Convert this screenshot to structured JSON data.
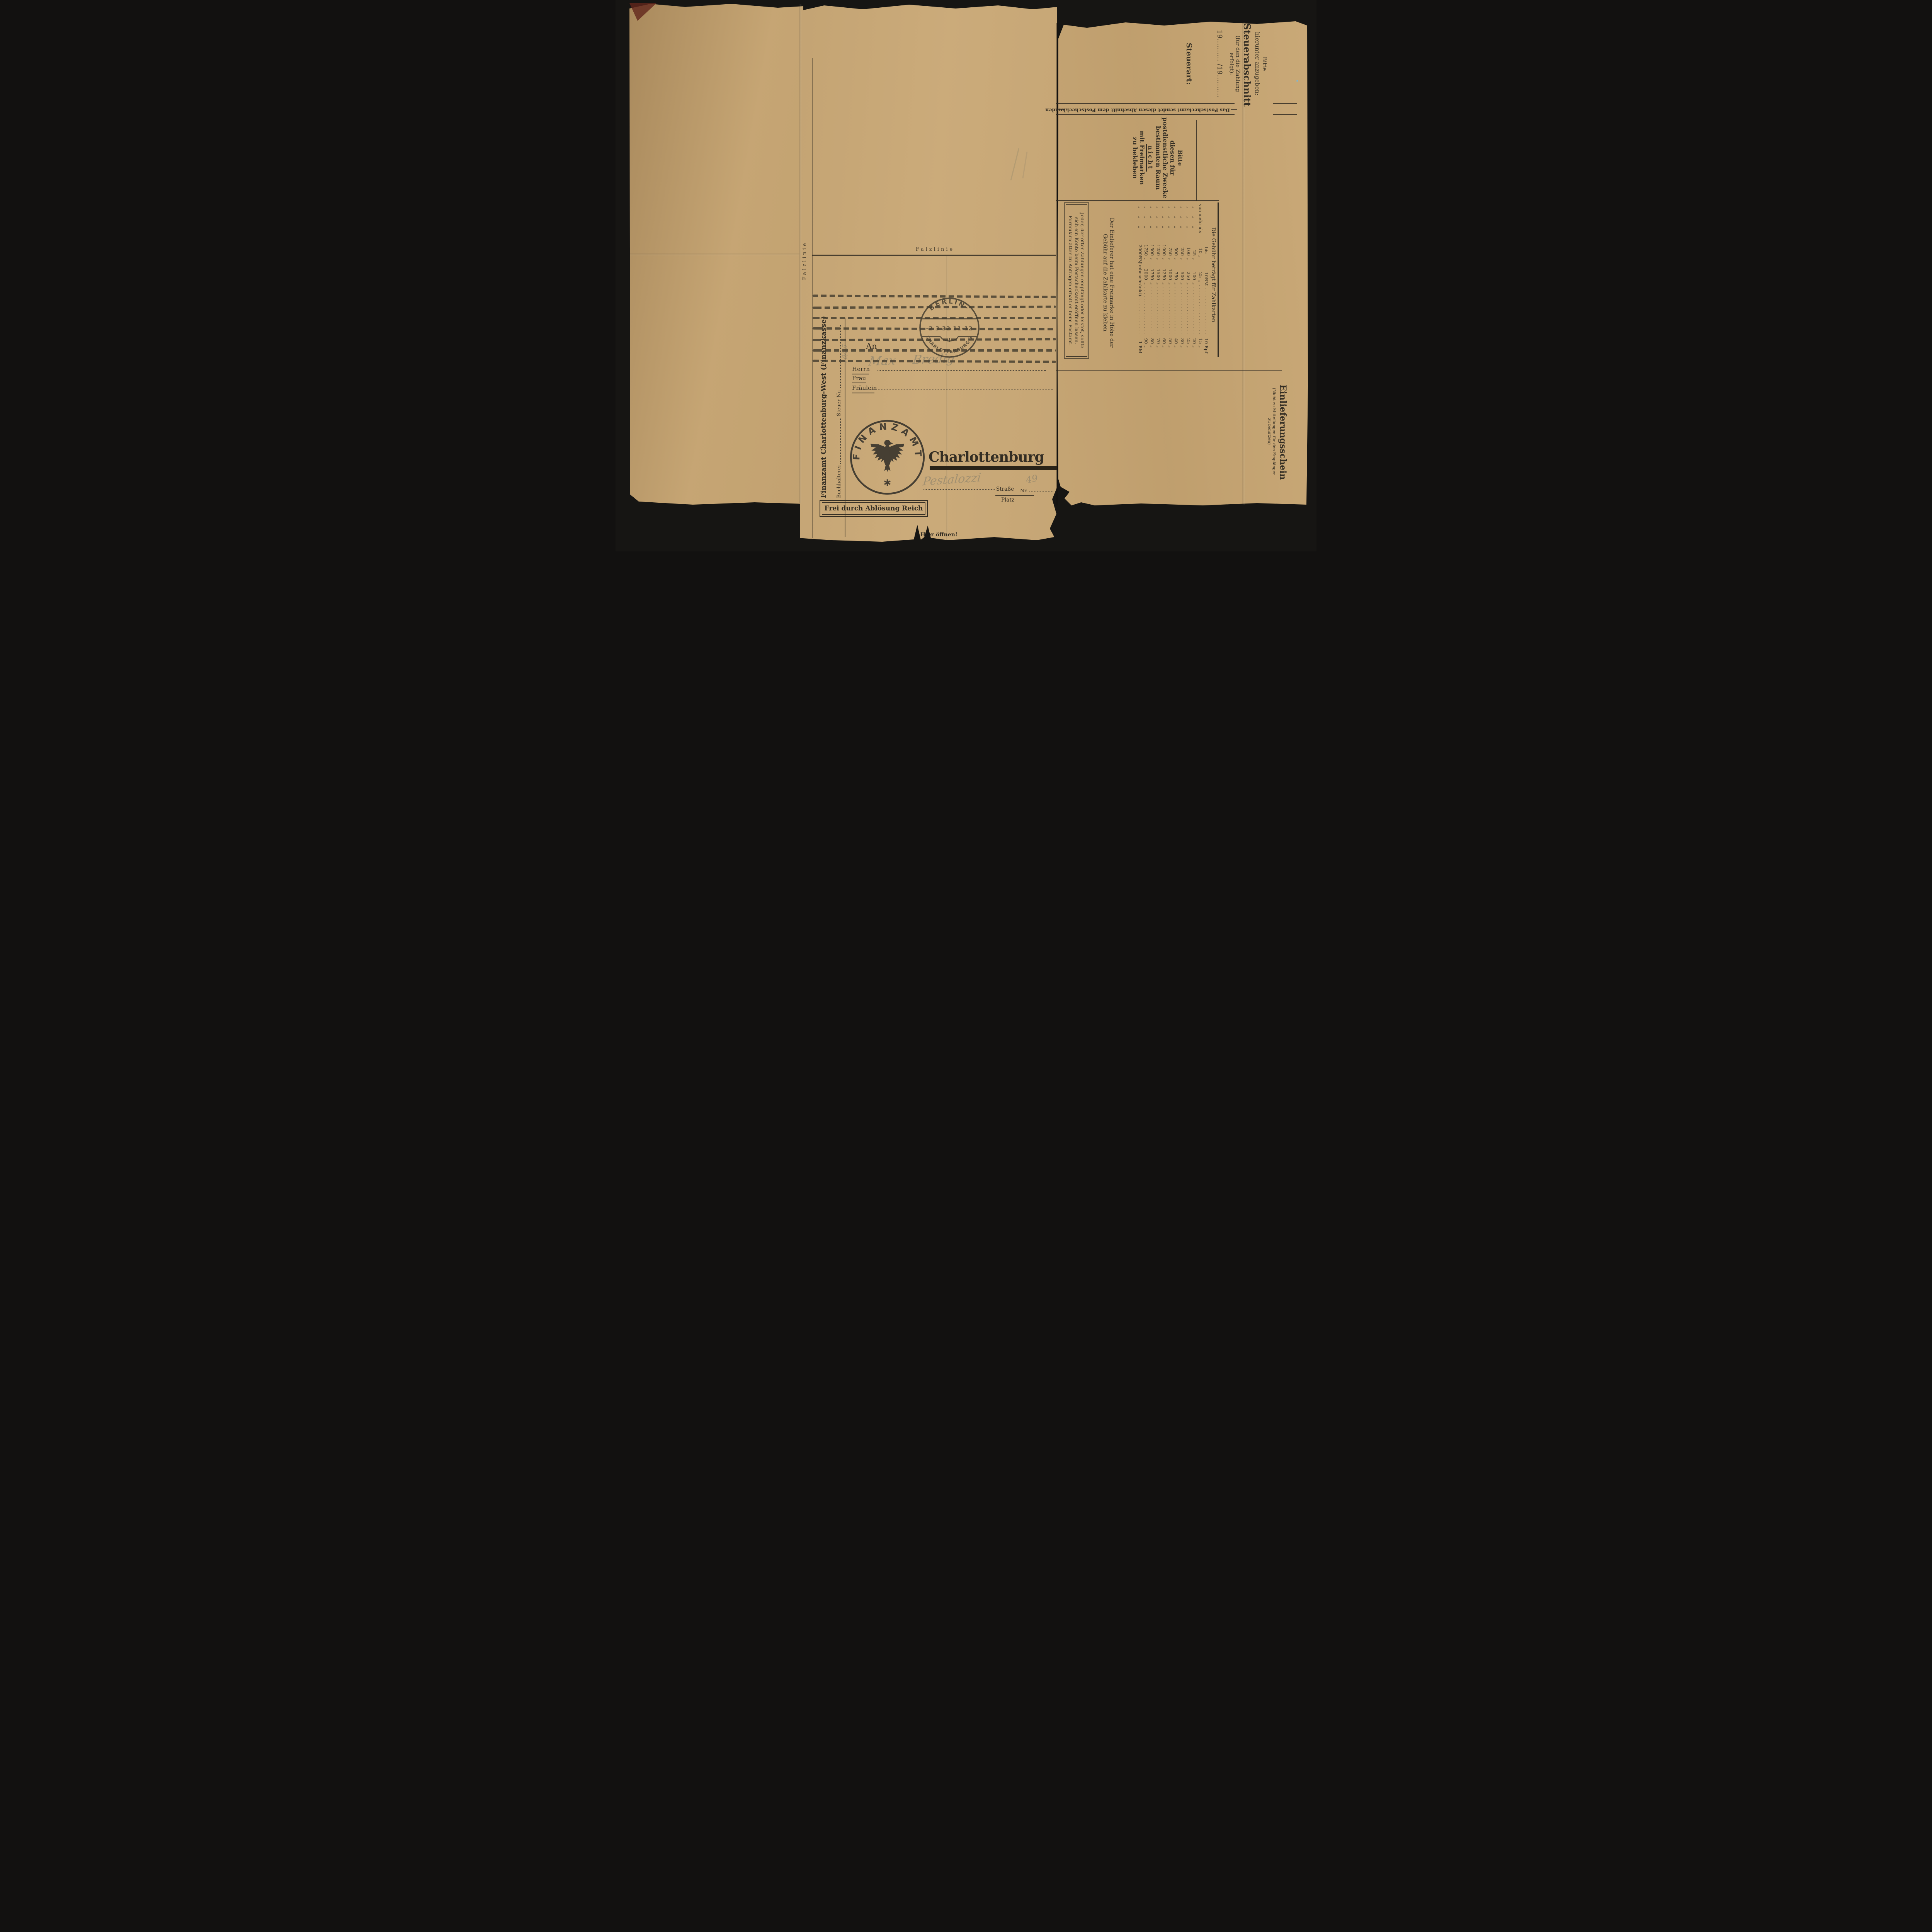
{
  "colors": {
    "paper": "#c7a572",
    "paper_dark": "#b2915f",
    "ink": "#332d23",
    "ink_soft": "#4a4336",
    "stamp": "#443d2f",
    "pencil": "#837c69",
    "bar": "#292318",
    "background": "#161513"
  },
  "stub": {
    "request_note": {
      "l1": "Bitte",
      "l2": "hierunter anzugeben:",
      "title": "Steuerabschnitt",
      "l3": "(für den die Zahlung",
      "l4": "erfolgt):",
      "years": "19.......... /19..........",
      "tax_type_label": "Steuerart:"
    },
    "postal_notice": "Das Postscheckamt sendet diesen Abschnitt dem Postscheckkunden",
    "no_stamps_note": {
      "l1": "Bitte",
      "l2": "diesen für",
      "l3": "postdienstliche Zwecke",
      "l4": "bestimmten Raum",
      "l5": "nicht",
      "l6": "mit Freimarken",
      "l7": "zu bekleben"
    },
    "fee_table": {
      "title": "Die Gebühr beträgt für Zahlkarten",
      "rows": [
        {
          "lead": "",
          "v1": "bis",
          "u1": "",
          "v2": "10",
          "u2": "RM",
          "fee": "10",
          "fu": "Rpf"
        },
        {
          "lead": "von mehr als",
          "v1": "10",
          "u1": "„",
          "v2": "25",
          "u2": "„",
          "fee": "15",
          "fu": "„"
        },
        {
          "lead": "„ „ „",
          "v1": "25",
          "u1": "„",
          "v2": "100",
          "u2": "„",
          "fee": "20",
          "fu": "„"
        },
        {
          "lead": "„ „ „",
          "v1": "100",
          "u1": "„",
          "v2": "250",
          "u2": "„",
          "fee": "25",
          "fu": "„"
        },
        {
          "lead": "„ „ „",
          "v1": "250",
          "u1": "„",
          "v2": "500",
          "u2": "„",
          "fee": "30",
          "fu": "„"
        },
        {
          "lead": "„ „ „",
          "v1": "500",
          "u1": "„",
          "v2": "750",
          "u2": "„",
          "fee": "40",
          "fu": "„"
        },
        {
          "lead": "„ „ „",
          "v1": "750",
          "u1": "„",
          "v2": "1000",
          "u2": "„",
          "fee": "50",
          "fu": "„"
        },
        {
          "lead": "„ „ „",
          "v1": "1000",
          "u1": "„",
          "v2": "1250",
          "u2": "„",
          "fee": "60",
          "fu": "„"
        },
        {
          "lead": "„ „ „",
          "v1": "1250",
          "u1": "„",
          "v2": "1500",
          "u2": "„",
          "fee": "70",
          "fu": "„"
        },
        {
          "lead": "„ „ „",
          "v1": "1500",
          "u1": "„",
          "v2": "1750",
          "u2": "„",
          "fee": "80",
          "fu": "„"
        },
        {
          "lead": "„ „ „",
          "v1": "1750",
          "u1": "„",
          "v2": "2000",
          "u2": "„",
          "fee": "90",
          "fu": "„"
        },
        {
          "lead": "„ „ „",
          "v1": "2000",
          "u1": "RM",
          "v2": "(unbeschränkt)",
          "u2": "",
          "fee": "1",
          "fu": "RM"
        }
      ]
    },
    "stamp_note": {
      "l1": "Der Einlieferer hat eine Freimarke in Höhe der",
      "l2": "Gebühr auf die Zahlkarte zu kleben"
    },
    "account_note": {
      "l1": "Jeder, der öfter Zahlungen empfängt oder leistet, sollte",
      "l2": "sich ein Konto beim Postscheckamt eröffnen lassen.",
      "l3": "Formularblätter zu Anträgen erhält er beim Postamt."
    },
    "receipt": {
      "title": "Einlieferungsschein",
      "sub1": "(Nicht zu Mitteilungen für den Empfänger",
      "sub2": "zu benutzen)"
    }
  },
  "envelope": {
    "fold_label_horizontal": "Falzlinie",
    "fold_label_vertical": "Falzlinie",
    "sender_line": "Finanzamt Charlottenburg-West (Finanzkasse)",
    "buchhalterei_label": "Buchhalterei",
    "steuer_nr_label": "Steuer-Nr.",
    "steuer_nr_handwritten": "10/25",
    "address": {
      "an": "An",
      "herrn": "Herrn",
      "frau": "Frau",
      "fraeulein": "Fräulein",
      "recipient_handwritten_first": "Max",
      "recipient_handwritten_last": "Bredig",
      "city": "Charlottenburg",
      "strasse_label": "Straße",
      "platz_label": "Platz",
      "nr_label": "Nr.",
      "street_handwritten": "Pestalozzi",
      "house_number_handwritten": "49"
    },
    "franking_box": "Frei durch Ablösung Reich",
    "open_here": "Hier öffnen!"
  },
  "postmark": {
    "city_top": "BERLIN-",
    "date_time": "-2 3 32 11-12",
    "letter": "I",
    "city_bottom": "CHARLOTTENBURG 2"
  },
  "seal": {
    "ring_text": "FINANZAMT"
  }
}
